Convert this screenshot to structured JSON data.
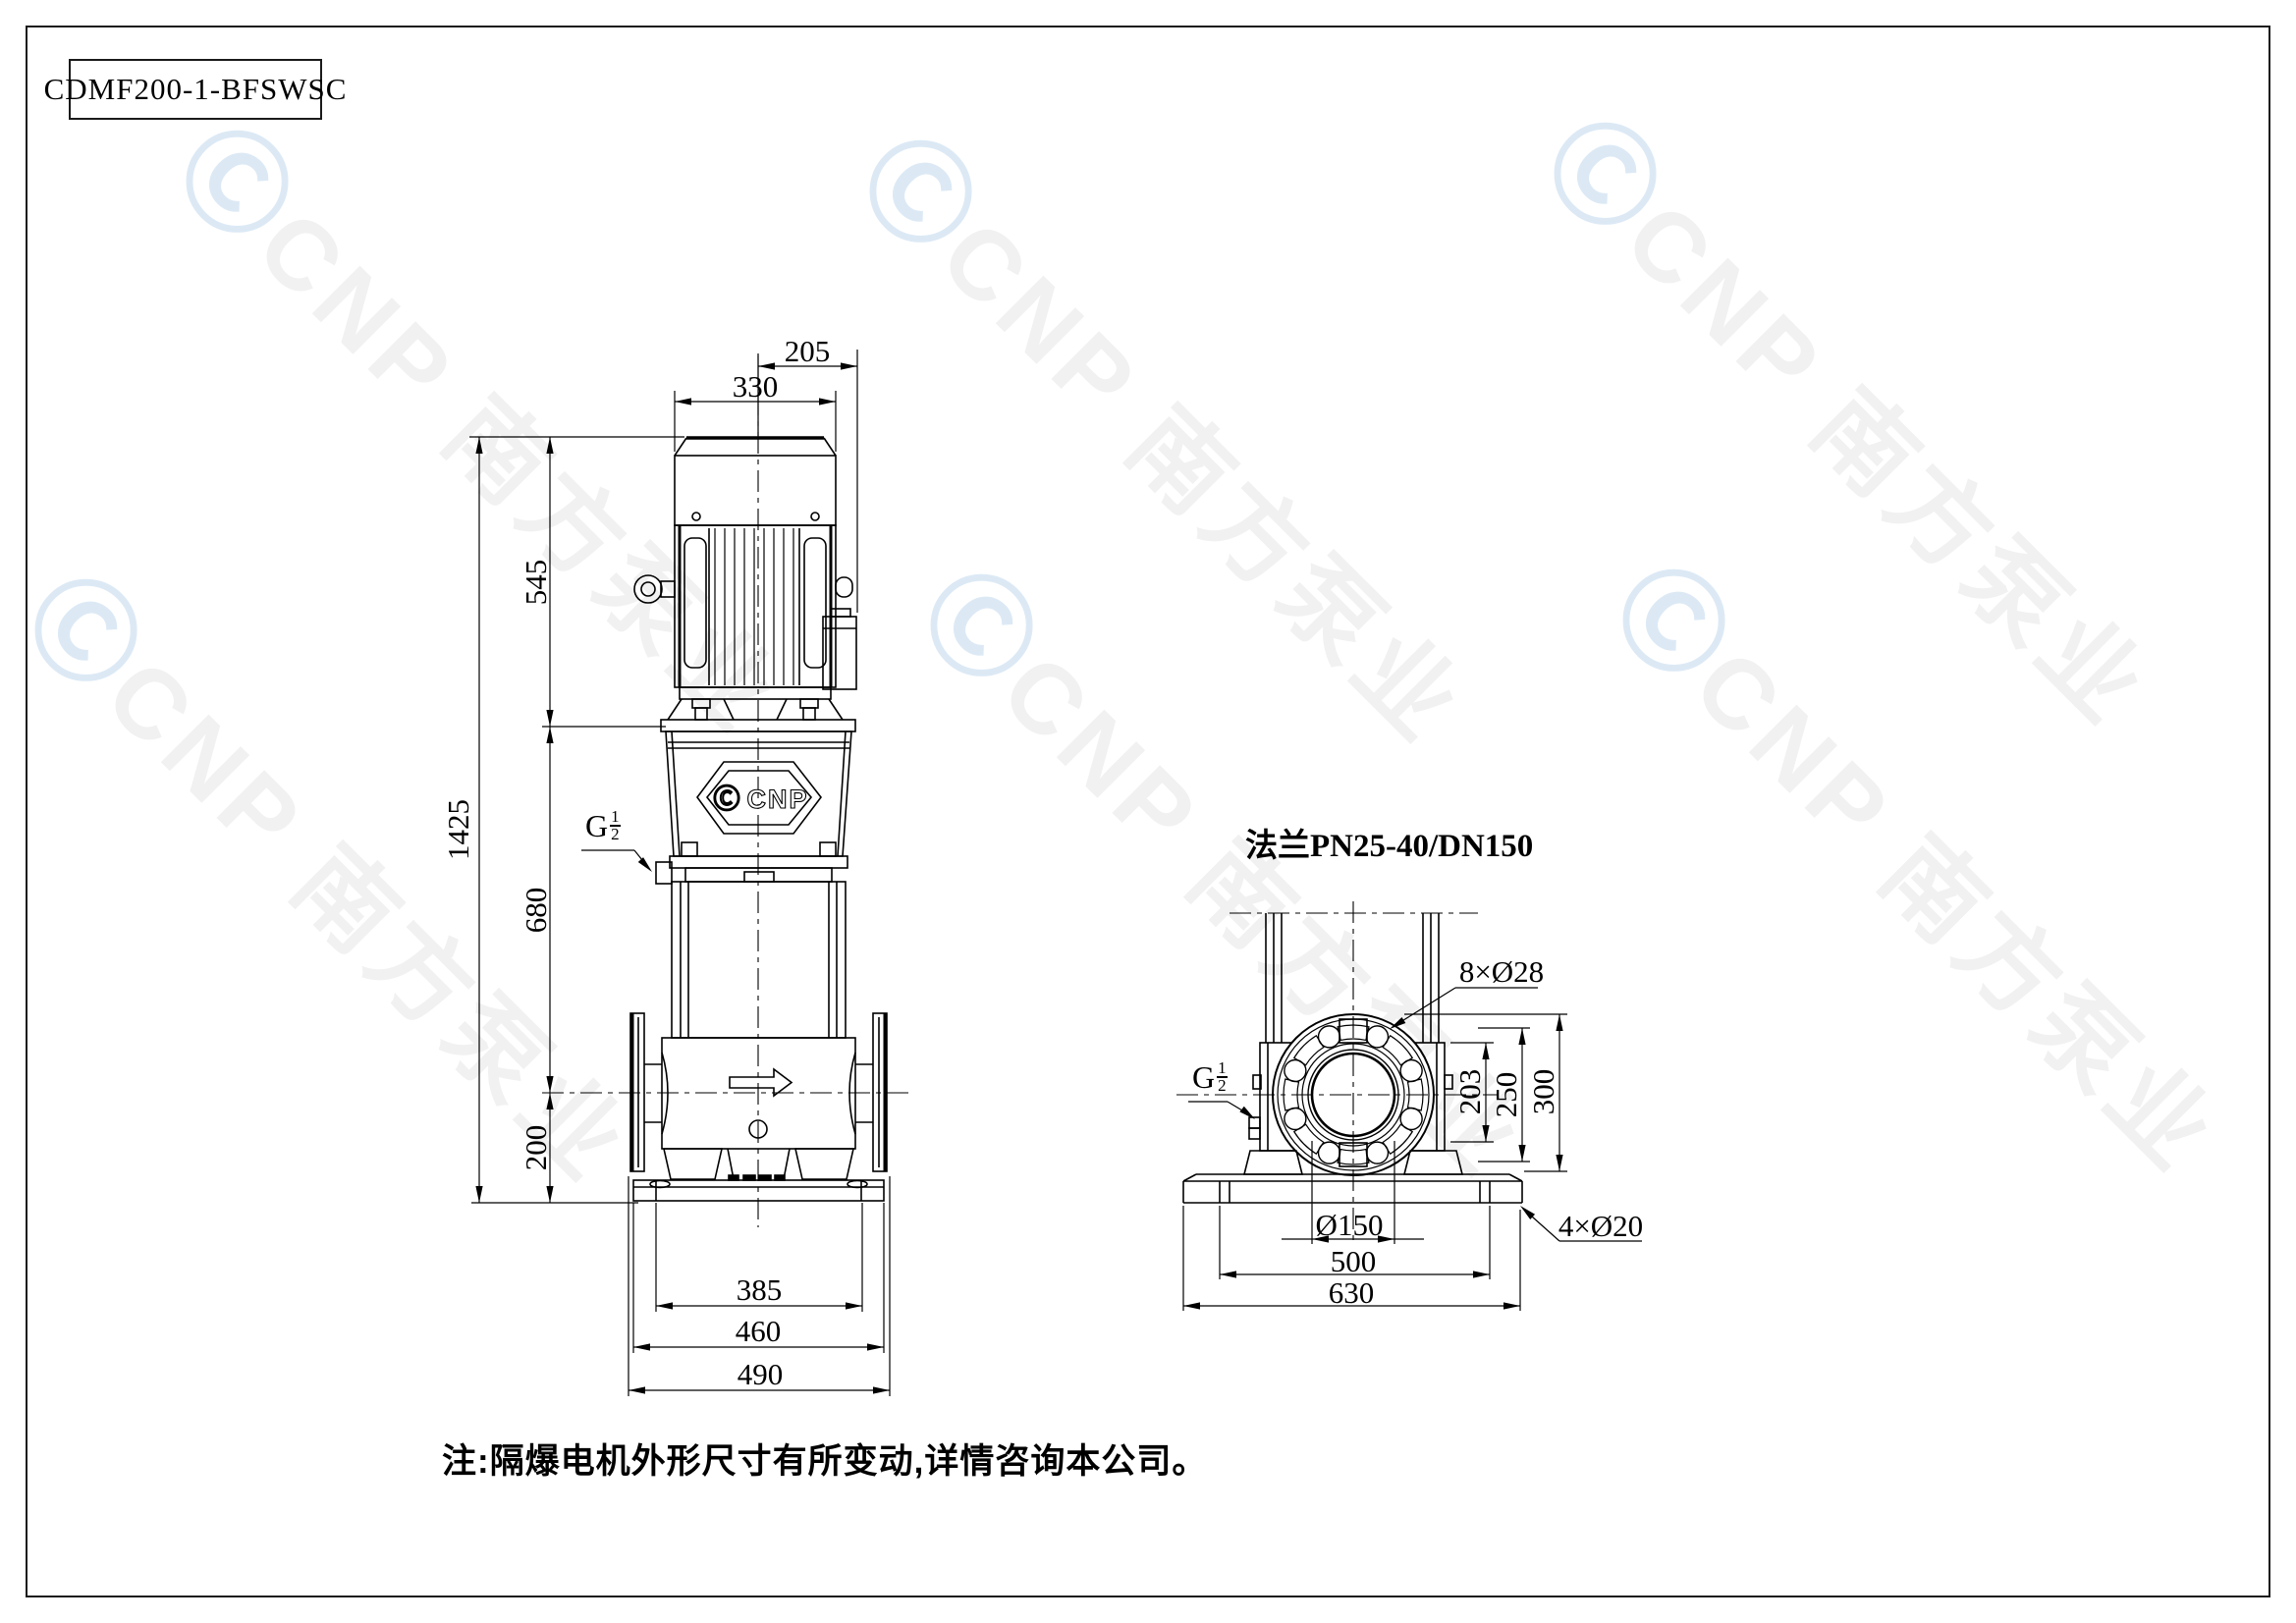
{
  "title_block": {
    "model": "CDMF200-1-BFSWSC"
  },
  "watermark": {
    "logo_glyph": "Ⓒ",
    "brand_text": "CNP 南方泵业"
  },
  "front_view": {
    "badge": {
      "logo": "Ⓒ",
      "text": "CNP"
    },
    "dims": {
      "motor_offset_top": "205",
      "motor_width": "330",
      "motor_height": "545",
      "total_height": "1425",
      "pump_mid_height": "680",
      "port_center_height": "200",
      "base_bolt_span": "385",
      "base_plate_width": "460",
      "flange_face_span": "490"
    },
    "drain_port": {
      "prefix": "G",
      "numerator": "1",
      "denominator": "2"
    }
  },
  "side_view": {
    "flange_spec": "法兰PN25-40/DN150",
    "dims": {
      "bolt_holes": "8×Ø28",
      "hub_height": "203",
      "coupling_height": "250",
      "flange_od_height": "300",
      "bore_diameter": "Ø150",
      "base_bolt_span": "500",
      "base_width": "630",
      "foundation_holes": "4×Ø20"
    },
    "drain_port": {
      "prefix": "G",
      "numerator": "1",
      "denominator": "2"
    }
  },
  "footnote": "注:隔爆电机外形尺寸有所变动,详情咨询本公司。",
  "colors": {
    "line": "#000000",
    "watermark_gray": "#f1f1f1",
    "watermark_blue": "#dce9f5",
    "paper": "#ffffff"
  }
}
